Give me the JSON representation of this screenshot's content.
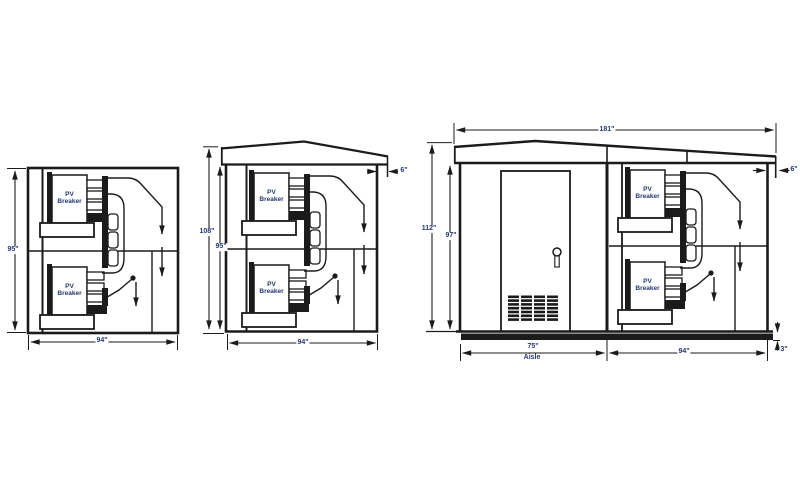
{
  "colors": {
    "line": "#1b1b1b",
    "text": "#25376e",
    "background": "#ffffff"
  },
  "equipment_label": {
    "pv_breaker": "PV\nBreaker"
  },
  "views": {
    "section": {
      "height": "95\"",
      "width": "94\""
    },
    "side": {
      "overall_height": "108\"",
      "interior_height": "95\"",
      "width": "94\"",
      "roof_overhang": "6\""
    },
    "front": {
      "overall_width": "181\"",
      "overall_height": "112\"",
      "interior_height": "97\"",
      "aisle_width": "75\"",
      "aisle_text": "Aisle",
      "bay_width": "94\"",
      "skid_height": "3\"",
      "roof_overhang": "6\""
    }
  }
}
